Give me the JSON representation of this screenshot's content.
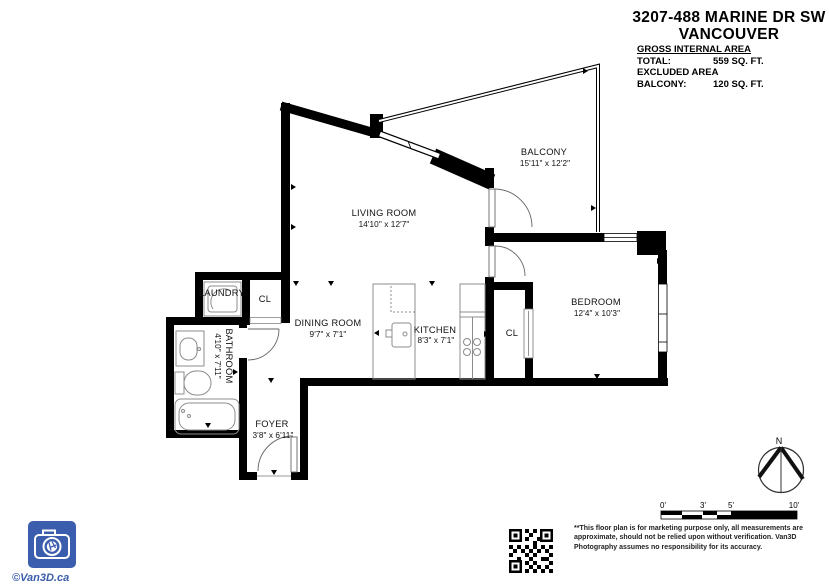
{
  "header": {
    "title_line1": "3207-488 MARINE DR SW",
    "title_line2": "VANCOUVER",
    "area_section_title": "GROSS INTERNAL AREA",
    "total_label": "TOTAL:",
    "total_value": "559 SQ. FT.",
    "excluded_label": "EXCLUDED AREA",
    "balcony_label": "BALCONY:",
    "balcony_value": "120 SQ. FT."
  },
  "rooms": {
    "living": {
      "name": "LIVING ROOM",
      "dims": "14'10\" x 12'7\""
    },
    "balcony": {
      "name": "BALCONY",
      "dims": "15'11\" x 12'2\""
    },
    "bedroom": {
      "name": "BEDROOM",
      "dims": "12'4\" x 10'3\""
    },
    "dining": {
      "name": "DINING ROOM",
      "dims": "9'7\" x 7'1\""
    },
    "kitchen": {
      "name": "KITCHEN",
      "dims": "8'3\" x 7'1\""
    },
    "bathroom": {
      "name": "BATHROOM",
      "dims": "4'10\" x 7'11\""
    },
    "foyer": {
      "name": "FOYER",
      "dims": "3'8\" x 6'11\""
    },
    "laundry": {
      "name": "LAUNDRY"
    },
    "closet_hall": {
      "name": "CL"
    },
    "closet_bedroom": {
      "name": "CL"
    }
  },
  "compass": {
    "north_label": "N"
  },
  "scale_bar": {
    "labels": [
      "0'",
      "3'",
      "5'",
      "10'"
    ]
  },
  "footer": {
    "disclaimer_lines": [
      "**This floor plan is for marketing purpose only, all measurements are",
      "approximate, should not be relied upon without verification. Van3D",
      "Photography assumes no responsibility for its accuracy."
    ],
    "logo_credit": "©Van3D.ca"
  },
  "colors": {
    "brand_blue": "#3a5dad",
    "wall": "#000000"
  }
}
